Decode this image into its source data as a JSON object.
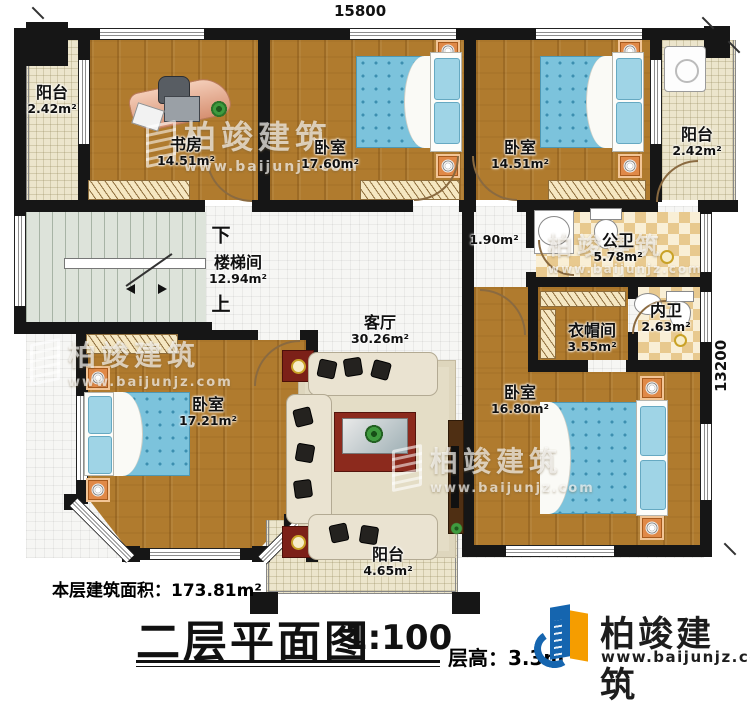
{
  "plan": {
    "dim_top": "15800",
    "dim_right": "13200",
    "stair_down": "下",
    "stair_up": "上",
    "hall_area": "1.90m²",
    "rooms": {
      "balcony_tl": {
        "name": "阳台",
        "area": "2.42m²"
      },
      "study": {
        "name": "书房",
        "area": "14.51m²"
      },
      "bedroom_a": {
        "name": "卧室",
        "area": "17.60m²"
      },
      "bedroom_b": {
        "name": "卧室",
        "area": "14.51m²"
      },
      "balcony_tr": {
        "name": "阳台",
        "area": "2.42m²"
      },
      "stairwell": {
        "name": "楼梯间",
        "area": "12.94m²"
      },
      "public_bath": {
        "name": "公卫",
        "area": "5.78m²"
      },
      "cloakroom": {
        "name": "衣帽间",
        "area": "3.55m²"
      },
      "inner_bath": {
        "name": "内卫",
        "area": "2.63m²"
      },
      "living": {
        "name": "客厅",
        "area": "30.26m²"
      },
      "bedroom_c": {
        "name": "卧室",
        "area": "17.21m²"
      },
      "bedroom_d": {
        "name": "卧室",
        "area": "16.80m²"
      },
      "balcony_bottom": {
        "name": "阳台",
        "area": "4.65m²"
      }
    }
  },
  "footer": {
    "floor_area_label": "本层建筑面积：",
    "floor_area_value": "173.81m²",
    "title": "二层平面图",
    "scale": "1:100",
    "floor_height_label": "层高：",
    "floor_height_value": "3.3m"
  },
  "branding": {
    "company": "柏竣建筑",
    "website": "www.baijunjz.com",
    "logo_blue": "#1565af",
    "logo_orange": "#f59d00"
  }
}
